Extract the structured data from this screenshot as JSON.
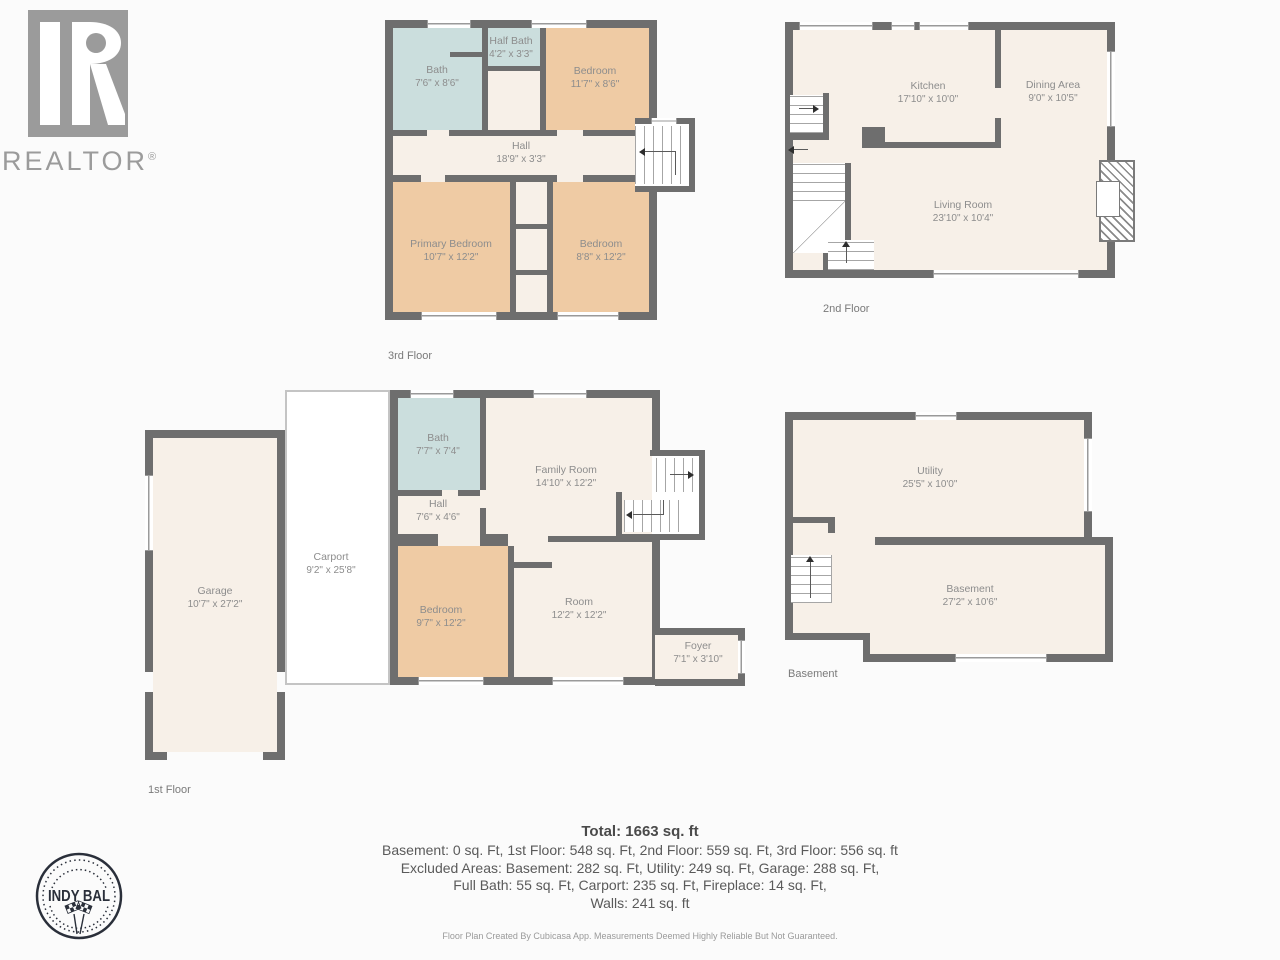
{
  "branding": {
    "realtor_text": "REALTOR",
    "realtor_reg": "®",
    "stamp_title": "INDY BAL"
  },
  "floors": {
    "third": {
      "label": "3rd Floor",
      "rooms": {
        "bath": {
          "name": "Bath",
          "dims": "7'6\" x 8'6\""
        },
        "half_bath": {
          "name": "Half Bath",
          "dims": "4'2\" x 3'3\""
        },
        "bedroom": {
          "name": "Bedroom",
          "dims": "11'7\" x 8'6\""
        },
        "hall": {
          "name": "Hall",
          "dims": "18'9\" x 3'3\""
        },
        "primary_bedroom": {
          "name": "Primary Bedroom",
          "dims": "10'7\" x 12'2\""
        },
        "bedroom2": {
          "name": "Bedroom",
          "dims": "8'8\" x 12'2\""
        }
      }
    },
    "second": {
      "label": "2nd Floor",
      "rooms": {
        "kitchen": {
          "name": "Kitchen",
          "dims": "17'10\" x 10'0\""
        },
        "dining": {
          "name": "Dining Area",
          "dims": "9'0\" x 10'5\""
        },
        "living": {
          "name": "Living Room",
          "dims": "23'10\" x 10'4\""
        }
      }
    },
    "first": {
      "label": "1st Floor",
      "rooms": {
        "garage": {
          "name": "Garage",
          "dims": "10'7\" x 27'2\""
        },
        "carport": {
          "name": "Carport",
          "dims": "9'2\" x 25'8\""
        },
        "bath": {
          "name": "Bath",
          "dims": "7'7\" x 7'4\""
        },
        "family": {
          "name": "Family Room",
          "dims": "14'10\" x 12'2\""
        },
        "hall": {
          "name": "Hall",
          "dims": "7'6\" x 4'6\""
        },
        "bedroom": {
          "name": "Bedroom",
          "dims": "9'7\" x 12'2\""
        },
        "room": {
          "name": "Room",
          "dims": "12'2\" x 12'2\""
        },
        "foyer": {
          "name": "Foyer",
          "dims": "7'1\" x 3'10\""
        }
      }
    },
    "basement": {
      "label": "Basement",
      "rooms": {
        "utility": {
          "name": "Utility",
          "dims": "25'5\" x 10'0\""
        },
        "basement": {
          "name": "Basement",
          "dims": "27'2\" x 10'6\""
        }
      }
    }
  },
  "summary": {
    "total": "Total: 1663 sq. ft",
    "line1": "Basement: 0 sq. Ft, 1st Floor: 548 sq. Ft, 2nd Floor: 559 sq. Ft, 3rd Floor: 556 sq. ft",
    "line2": "Excluded Areas: Basement: 282 sq. Ft, Utility: 249 sq. Ft, Garage: 288 sq. Ft,",
    "line3": "Full Bath: 55 sq. Ft, Carport: 235 sq. Ft, Fireplace: 14 sq. Ft,",
    "line4": "Walls: 241 sq. ft"
  },
  "footer": "Floor Plan Created By Cubicasa App. Measurements Deemed Highly Reliable But Not Guaranteed.",
  "colors": {
    "wall": "#6e6e6e",
    "floor": "#f7f0e8",
    "bedroom": "#efcba4",
    "bath": "#cbdedd",
    "stamp": "#2a2f3a",
    "logo_gray": "#9b9b9b"
  }
}
